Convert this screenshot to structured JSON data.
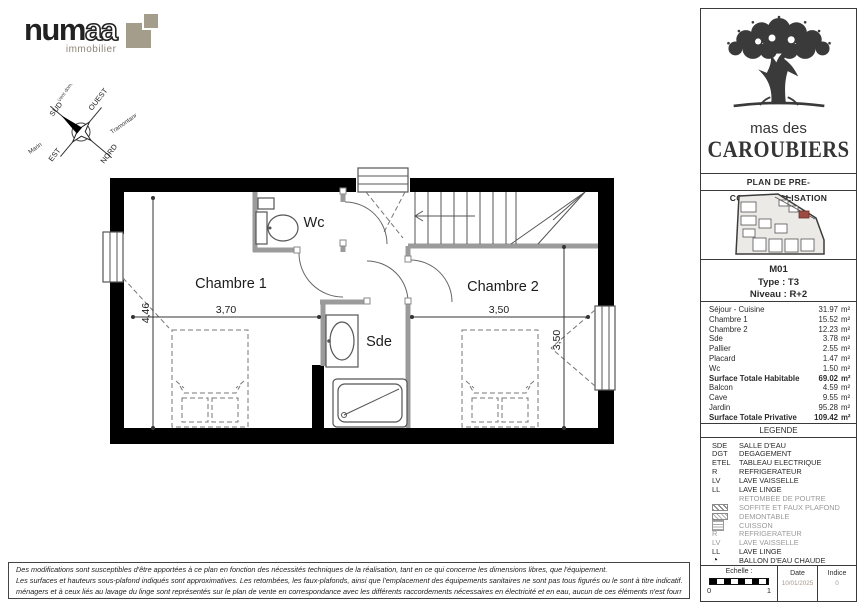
{
  "branding": {
    "name_start": "num",
    "name_accent": "aa",
    "subtitle": "immobilier"
  },
  "compass": {
    "north": "NORD",
    "south": "SUD",
    "east": "EST",
    "west": "OUEST",
    "wind_left": "Marin",
    "wind_right": "Tramontane",
    "wind_top": "Vent dominant"
  },
  "plan": {
    "room_wc": "Wc",
    "room_chambre1": "Chambre 1",
    "room_chambre2": "Chambre 2",
    "room_sde": "Sde",
    "dim_height_left": "4,46",
    "dim_width_chambre1": "3,70",
    "dim_width_chambre2": "3,50",
    "dim_height_right": "3,50"
  },
  "project": {
    "name_line1": "mas des",
    "name_line2": "CAROUBIERS",
    "doc_title": "PLAN DE PRE-COMMERCIALISATION"
  },
  "unit": {
    "code": "M01",
    "type_label": "Type : T3",
    "level_label": "Niveau : R+2"
  },
  "surface_table": {
    "unit": "m²",
    "rows": [
      {
        "label": "Séjour - Cuisine",
        "value": "31.97"
      },
      {
        "label": "Chambre 1",
        "value": "15.52"
      },
      {
        "label": "Chambre 2",
        "value": "12.23"
      },
      {
        "label": "Sde",
        "value": "3.78"
      },
      {
        "label": "Pallier",
        "value": "2.55"
      },
      {
        "label": "Placard",
        "value": "1.47"
      },
      {
        "label": "Wc",
        "value": "1.50"
      },
      {
        "label": "Surface Totale Habitable",
        "value": "69.02"
      },
      {
        "label": "Balcon",
        "value": "4.59"
      },
      {
        "label": "Cave",
        "value": "9.55"
      },
      {
        "label": "Jardin",
        "value": "95.28"
      },
      {
        "label": "Surface Totale Privative",
        "value": "109.42"
      }
    ]
  },
  "legend": {
    "title": "LEGENDE",
    "rows": [
      {
        "code": "SDE",
        "symbol": "code",
        "label": "SALLE D'EAU"
      },
      {
        "code": "DGT",
        "symbol": "code",
        "label": "DEGAGEMENT"
      },
      {
        "code": "ETEL",
        "symbol": "code",
        "label": "TABLEAU ELECTRIQUE"
      },
      {
        "code": "R",
        "symbol": "code",
        "label": "REFRIGERATEUR"
      },
      {
        "code": "LV",
        "symbol": "code",
        "label": "LAVE VAISSELLE"
      },
      {
        "code": "LL",
        "symbol": "code",
        "label": "LAVE LINGE"
      },
      {
        "code": "",
        "symbol": "none",
        "label": "RETOMBEE DE POUTRE"
      },
      {
        "code": "",
        "symbol": "hatch",
        "label": "SOFFITE ET FAUX PLAFOND"
      },
      {
        "code": "",
        "symbol": "hatch-light",
        "label": "DEMONTABLE"
      },
      {
        "code": "",
        "symbol": "dots",
        "label": "CUISSON"
      },
      {
        "code": "R",
        "symbol": "code",
        "label": "REFRIGERATEUR"
      },
      {
        "code": "LV",
        "symbol": "code",
        "label": "LAVE VAISSELLE"
      },
      {
        "code": "LL",
        "symbol": "code",
        "label": "LAVE LINGE"
      },
      {
        "code": "",
        "symbol": "ballon",
        "label": "BALLON D'EAU CHAUDE"
      }
    ]
  },
  "footer": {
    "scale_label": "Echelle :",
    "scale_start": "0",
    "scale_end": "1",
    "date_label": "Date",
    "date_value": "10/01/2025",
    "index_label": "Indice",
    "index_value": "0"
  },
  "disclaimer": {
    "line1": "Des modifications sont susceptibles d'être apportées à ce plan en fonction des nécessités techniques de la réalisation, tant en ce qui concerne les dimensions libres, que l'équipement.",
    "line2": "Les surfaces et hauteurs sous-plafond indiqués sont approximatives. Les retombées, les faux-plafonds, ainsi que l'emplacement des équipements sanitaires ne sont pas tous figurés ou le sont à titre indicatif. Les emplacements dévolus aux équipements",
    "line3": "ménagers et à ceux liés au lavage du linge sont représentés sur le plan de vente en correspondance avec les différents raccordements nécessaires en électricité et en eau, aucun de ces éléments n'est fourni, à l'exception de ceux indiqués au descriptif."
  }
}
